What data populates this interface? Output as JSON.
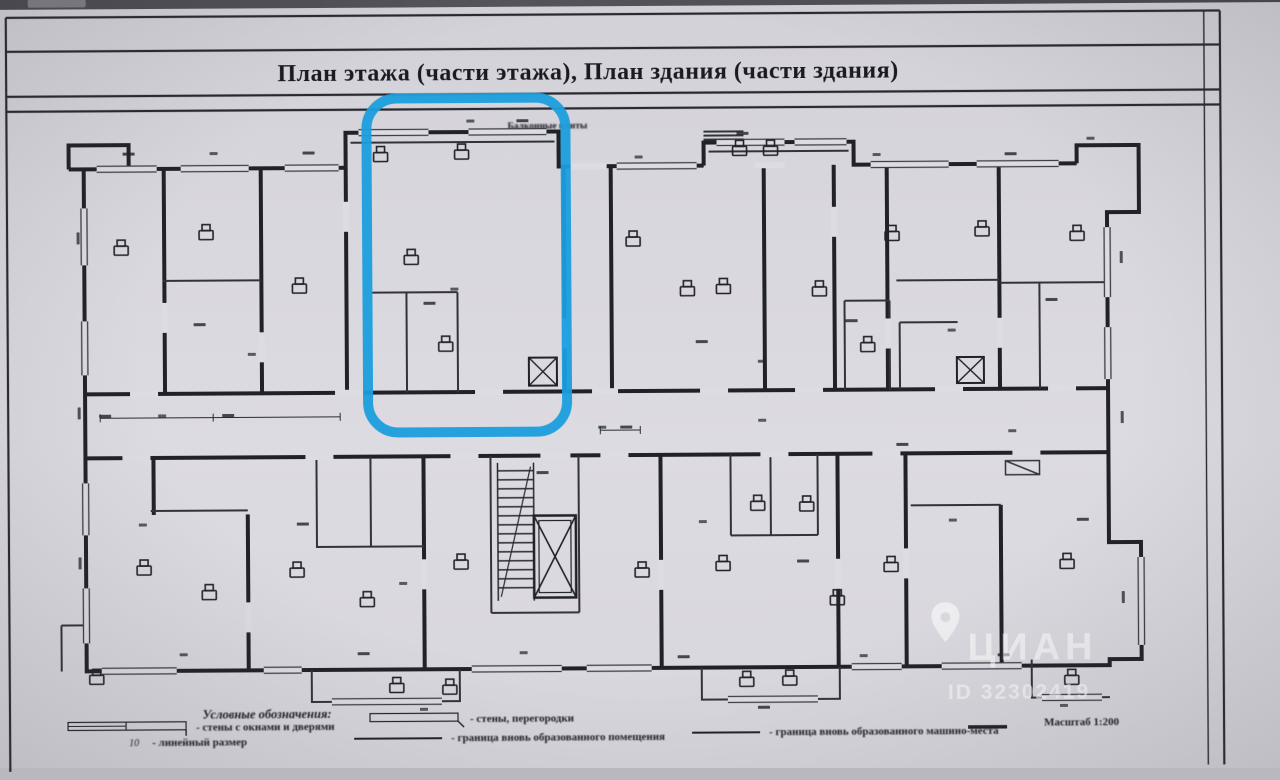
{
  "title_block": {
    "title": "План этажа (части этажа), План здания (части здания)"
  },
  "plan_annotation": {
    "top_label": "Балконные плиты"
  },
  "legend": {
    "heading": "Условные обозначения:",
    "wall_window_item": "- стены с окнами и дверями",
    "dimension_example": "10",
    "dimension_item": "- линейный размер",
    "partition_item": "- стены, перегородки",
    "boundary_item": "- граница вновь образованного помещения",
    "parking_boundary_item": "- граница вновь образованного машино-места",
    "scale": "Масштаб 1:200"
  },
  "highlight": {
    "shape": "rounded-rectangle",
    "color": "#1E9EDC"
  },
  "watermark": {
    "icon": "map-pin-icon",
    "brand": "ЦИАН",
    "listing_id": "ID 32302419"
  }
}
